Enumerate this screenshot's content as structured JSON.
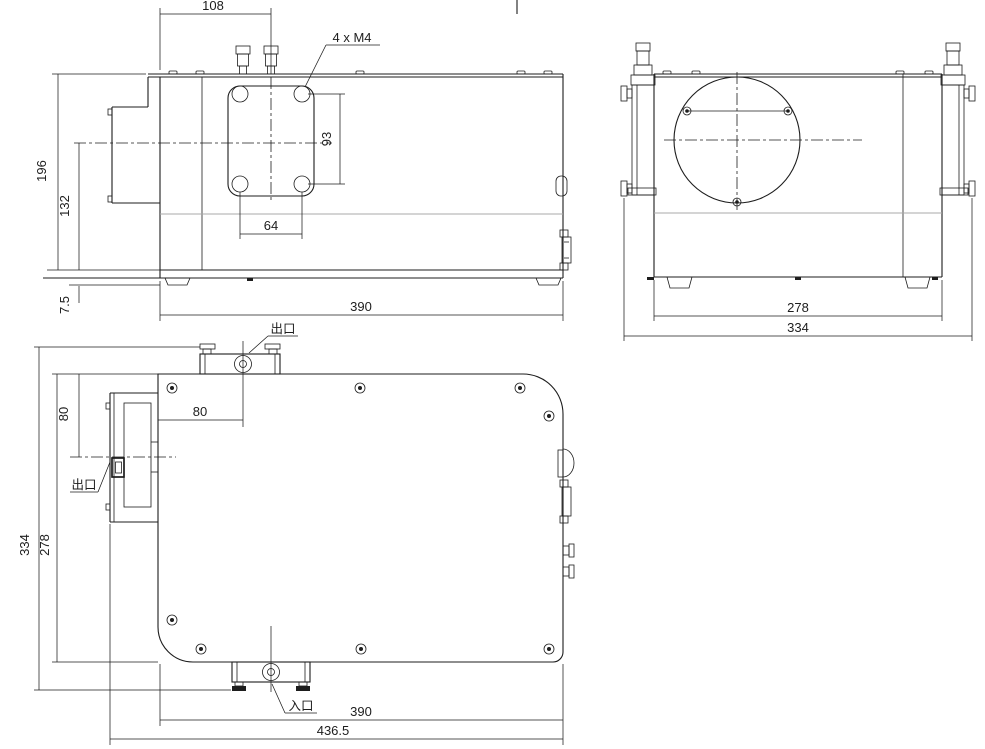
{
  "page": {
    "background": "#ffffff"
  },
  "drawing": {
    "type": "3-view engineering drawing of a boxed laser/chiller unit with coolant ports",
    "line_color": "#1d1d1d",
    "seam_color": "#a8a8a8",
    "front_view": {
      "dim_top_width": "108",
      "thread_note": "4 x  M4",
      "dim_hole_spacing_v": "93",
      "dim_hole_spacing_h": "64",
      "dim_overall_height": "196",
      "dim_axis_height": "132",
      "dim_foot_height": "7.5",
      "dim_overall_width": "390"
    },
    "side_view": {
      "dim_body_width": "278",
      "dim_overall_width": "334"
    },
    "top_view": {
      "outlet_top_label": "出口",
      "outlet_side_label": "出口",
      "inlet_label": "入口",
      "dim_outlet_offset": "80",
      "dim_connector_offset": "80",
      "dim_overall_depth": "334",
      "dim_body_depth": "278",
      "dim_body_width": "390",
      "dim_overall_width": "436.5"
    }
  }
}
